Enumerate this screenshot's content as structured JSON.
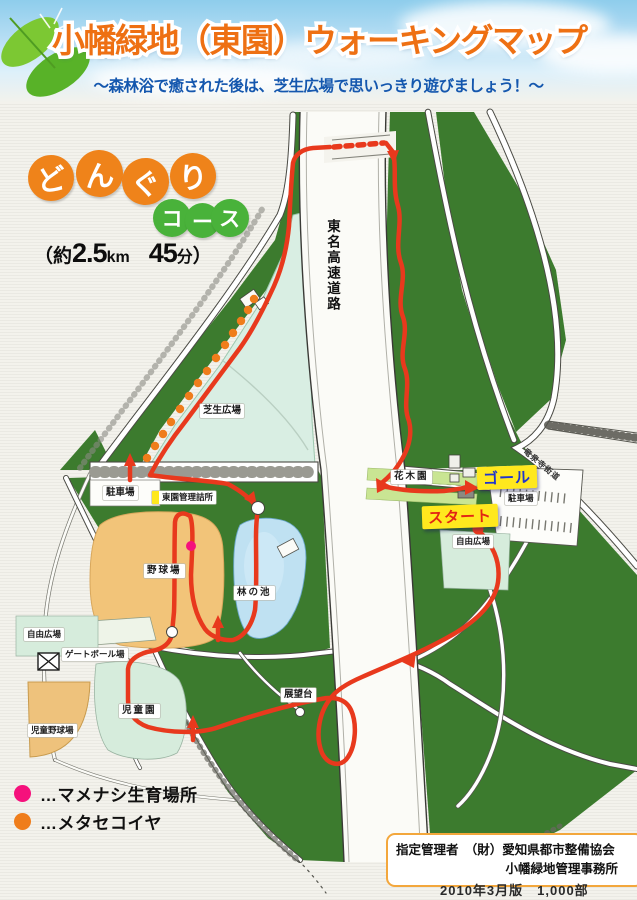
{
  "header": {
    "title": "小幡緑地（東園）ウォーキングマップ",
    "subtitle": "～森林浴で癒された後は、芝生広場で思いっきり遊びましょう！～"
  },
  "course": {
    "chars": [
      "ど",
      "ん",
      "ぐ",
      "り"
    ],
    "suffix": [
      "コ",
      "ー",
      "ス"
    ],
    "info": {
      "open": "（約",
      "num1": "2.5",
      "unit1": "km",
      "num2": "45",
      "unit2": "分",
      "close": "）"
    }
  },
  "map": {
    "highway": "東名高速道路",
    "road_ne": "竜泉寺街道",
    "labels": {
      "shibafu": "芝生広場",
      "parking_w": "駐車場",
      "office": "東園管理詰所",
      "baseball": "野球場",
      "pond": "林の池",
      "gateball": "ゲートボール場",
      "free_w": "自由広場",
      "jidoen": "児童園",
      "jido_yakyu": "児童野球場",
      "tenbodai": "展望台",
      "kaboku": "花木園",
      "free_e": "自由広場",
      "parking_e": "駐車場"
    },
    "markers": {
      "goal": "ゴール",
      "start": "スタート"
    }
  },
  "legend": {
    "items": [
      {
        "label": "…マメナシ生育場所",
        "color": "#f5117c"
      },
      {
        "label": "…メタセコイヤ",
        "color": "#ef7d1b"
      }
    ]
  },
  "footer": {
    "line1": "指定管理者　（財）愛知県都市整備協会",
    "line2": "小幡緑地管理事務所",
    "edition": "2010年3月版　1,000部"
  }
}
